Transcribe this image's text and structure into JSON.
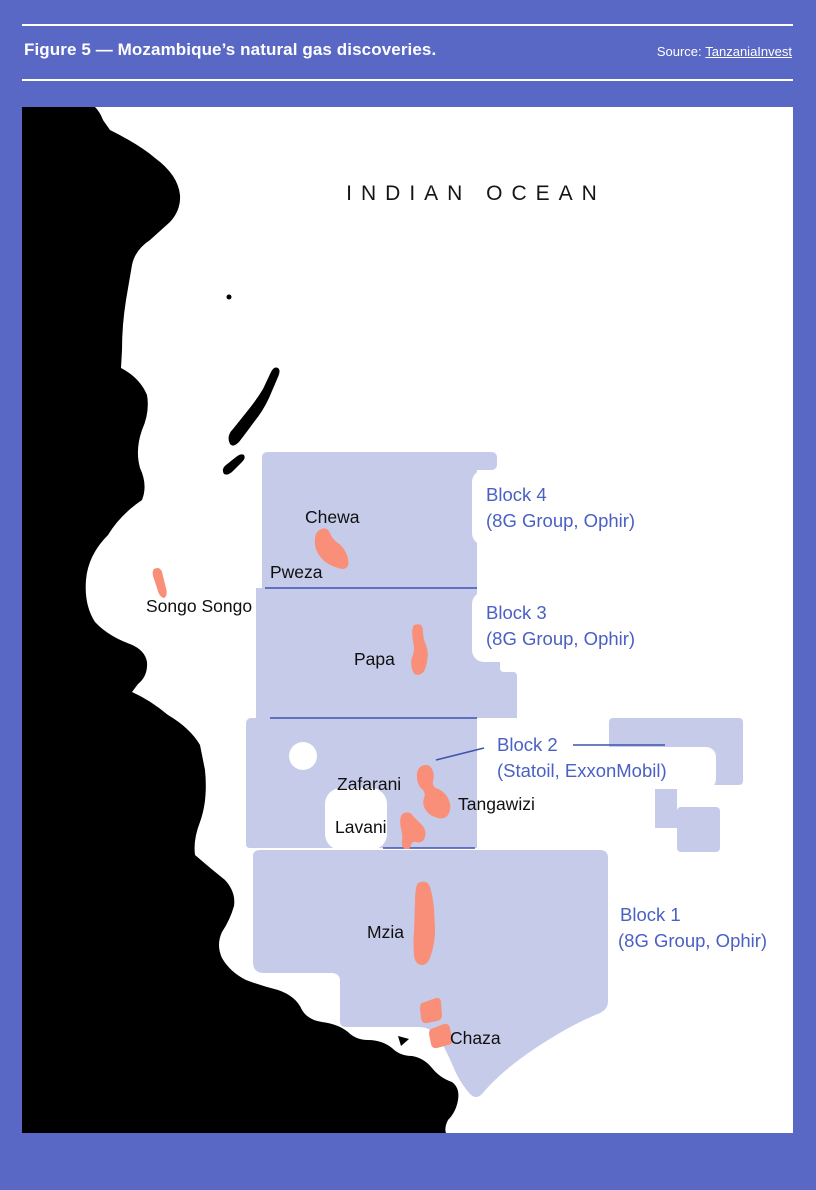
{
  "figure": {
    "title": "Figure 5 — Mozambique’s natural gas discoveries.",
    "source_label": "Source:",
    "source_link": "TanzaniaInvest"
  },
  "map": {
    "ocean_label": "INDIAN OCEAN",
    "blocks": [
      {
        "name": "Block 4",
        "operators": "(8G Group, Ophir)"
      },
      {
        "name": "Block 3",
        "operators": "(8G Group, Ophir)"
      },
      {
        "name": "Block 2",
        "operators": "(Statoil, ExxonMobil)"
      },
      {
        "name": "Block 1",
        "operators": "(8G Group, Ophir)"
      }
    ],
    "fields": [
      {
        "label": "Chewa"
      },
      {
        "label": "Pweza"
      },
      {
        "label": "Songo Songo"
      },
      {
        "label": "Papa"
      },
      {
        "label": "Zafarani"
      },
      {
        "label": "Tangawizi"
      },
      {
        "label": "Lavani"
      },
      {
        "label": "Mzia"
      },
      {
        "label": "Chaza"
      }
    ],
    "colors": {
      "page_purple": "#5a68c5",
      "block_lavender": "#c5cbe9",
      "gas_field_salmon": "#f98f78",
      "block_label_blue": "#4a60c4",
      "boundary_line_blue": "#3d52b0",
      "land_black": "#000000",
      "ocean_white": "#ffffff"
    }
  }
}
